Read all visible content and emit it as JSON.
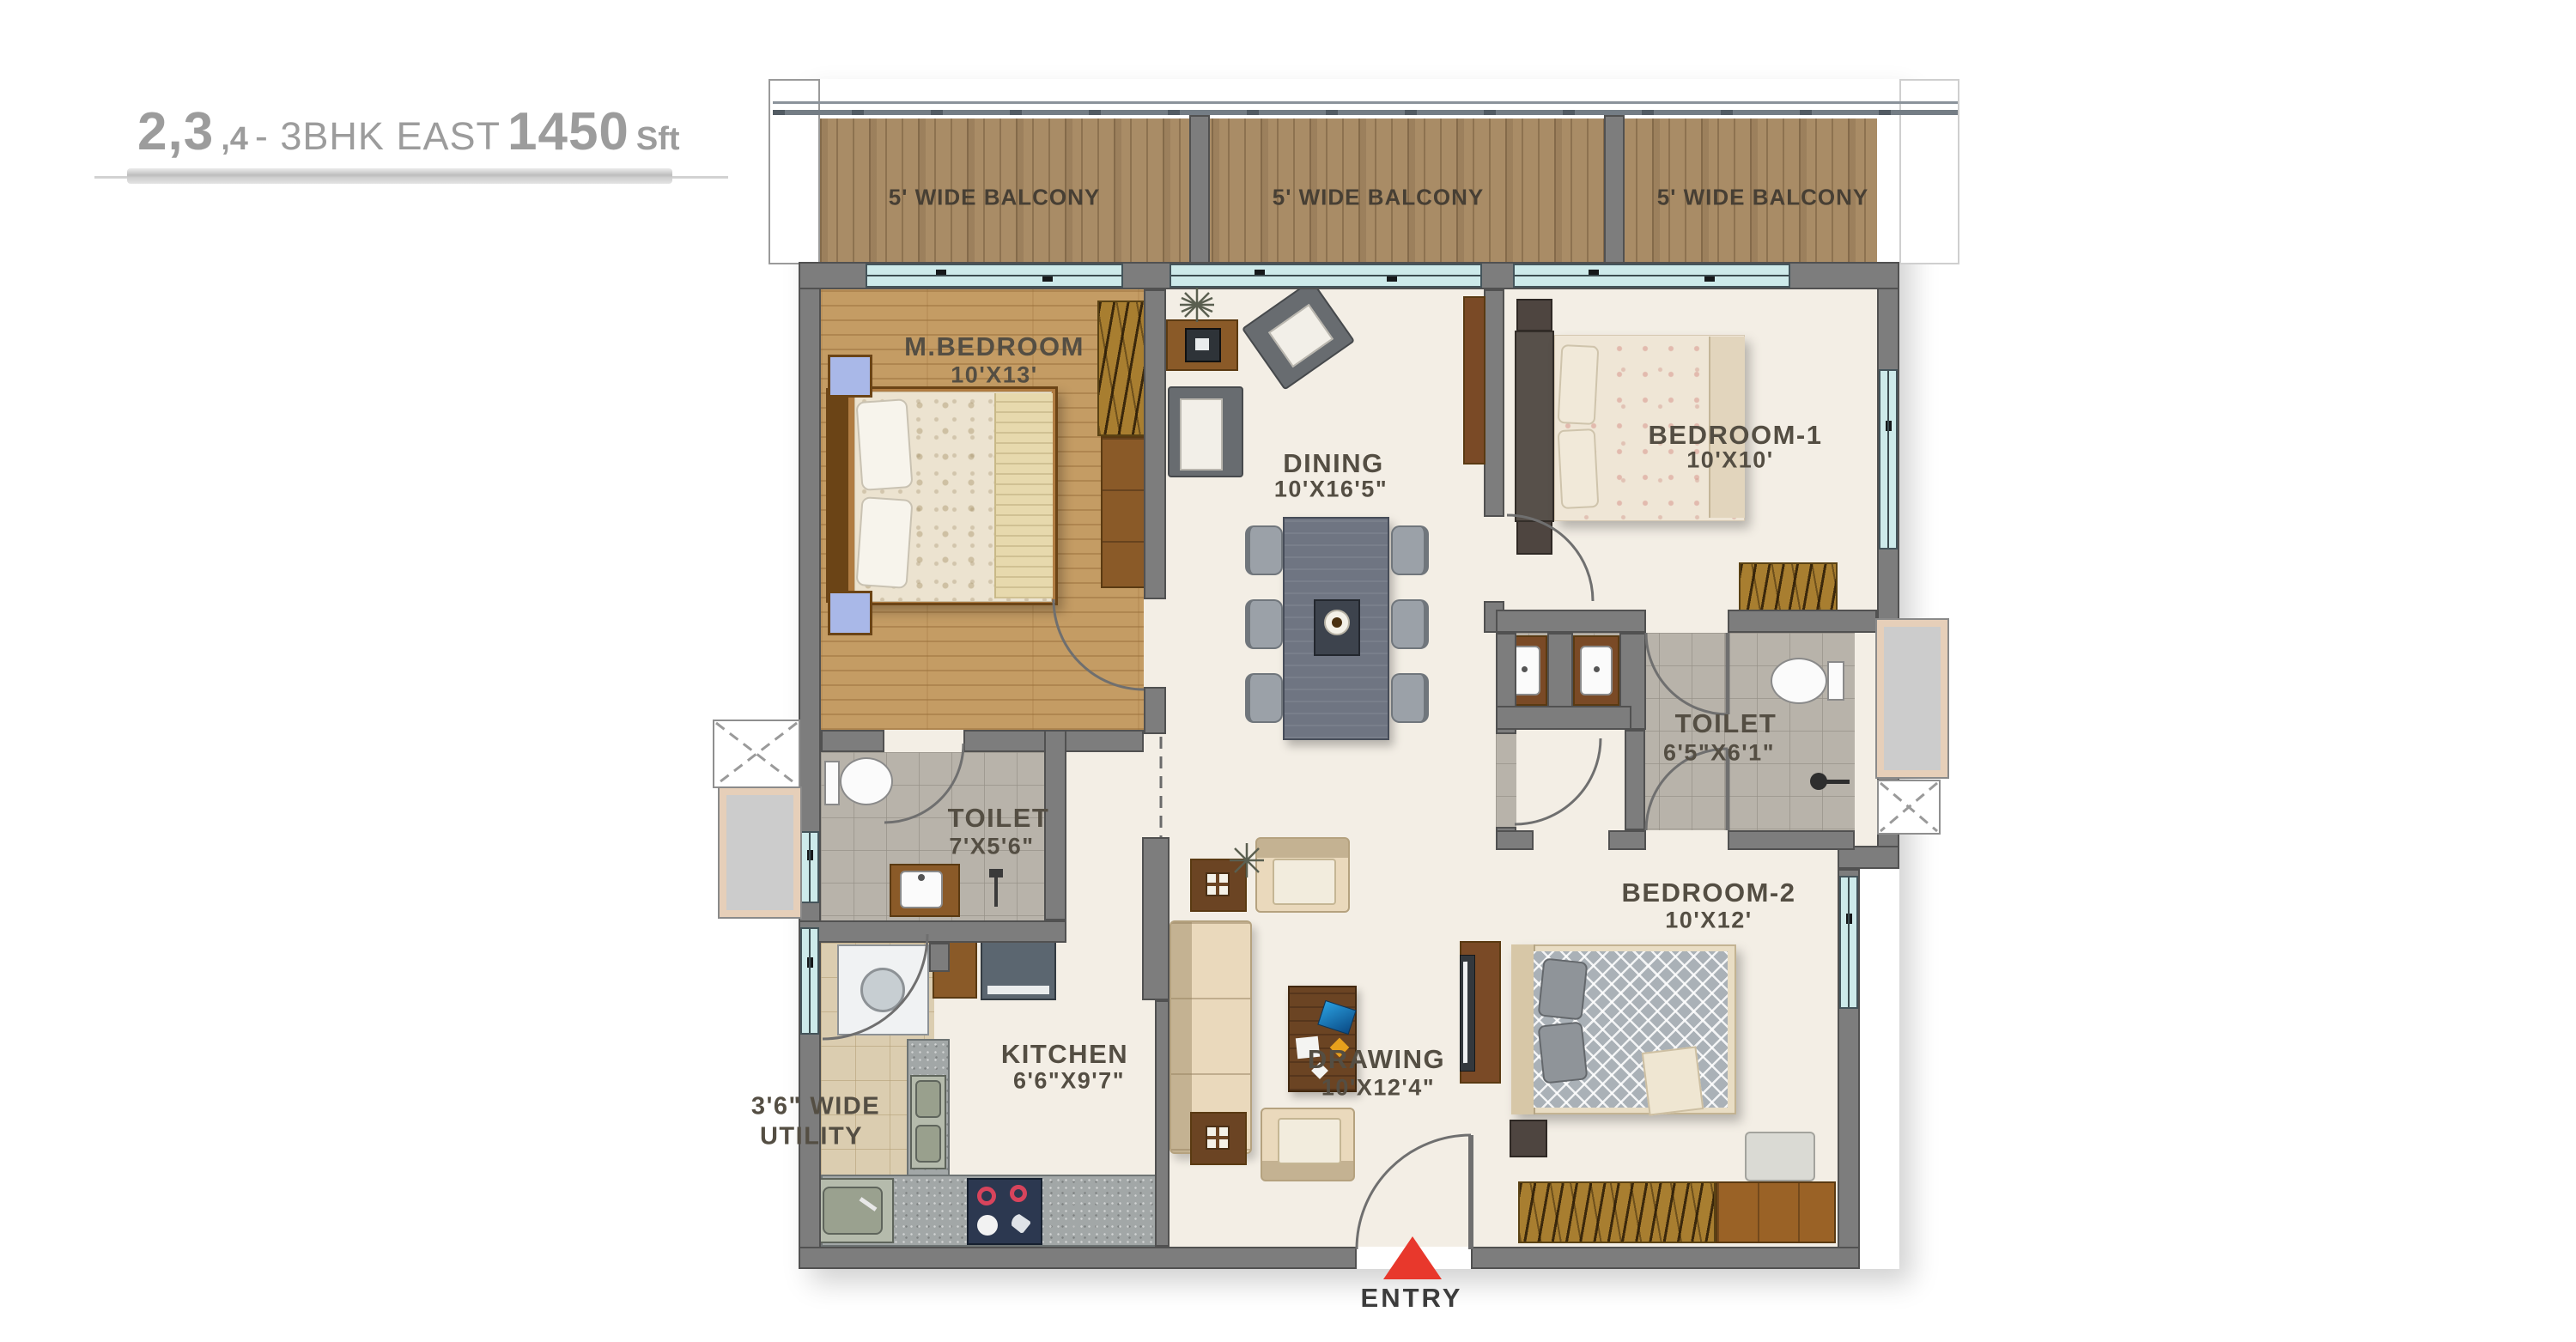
{
  "title": {
    "part1": "2,3",
    "part2": ",4",
    "part3": "- 3BHK EAST",
    "part4": "1450",
    "part5": "Sft"
  },
  "balconies": [
    {
      "label": "5' WIDE BALCONY"
    },
    {
      "label": "5' WIDE BALCONY"
    },
    {
      "label": "5' WIDE BALCONY"
    }
  ],
  "rooms": {
    "master_bedroom": {
      "name": "M.BEDROOM",
      "dims": "10'X13'"
    },
    "dining": {
      "name": "DINING",
      "dims": "10'X16'5\""
    },
    "bedroom1": {
      "name": "BEDROOM-1",
      "dims": "10'X10'"
    },
    "toilet1": {
      "name": "TOILET",
      "dims": "7'X5'6\""
    },
    "toilet2": {
      "name": "TOILET",
      "dims": "6'5\"X6'1\""
    },
    "kitchen": {
      "name": "KITCHEN",
      "dims": "6'6\"X9'7\""
    },
    "utility": {
      "line1": "3'6\" WIDE",
      "line2": "UTILITY"
    },
    "drawing": {
      "name": "DRAWING",
      "dims": "10'X12'4\""
    },
    "bedroom2": {
      "name": "BEDROOM-2",
      "dims": "10'X12'"
    }
  },
  "entry": {
    "label": "ENTRY"
  },
  "colors": {
    "title_gray": "#9c9c9c",
    "wall": "#7d7d7d",
    "balcony_wood": "#a98c66",
    "bedroom_wood": "#c49c64",
    "cream_floor": "#f3eee5",
    "toilet_tile": "#b8b3aa",
    "utility_tile": "#dbcdb0",
    "window_cyan": "#cdeaea",
    "wardrobe_hatch": "#a87e30",
    "entry_red": "#e8382c",
    "label_text": "#544e43"
  }
}
